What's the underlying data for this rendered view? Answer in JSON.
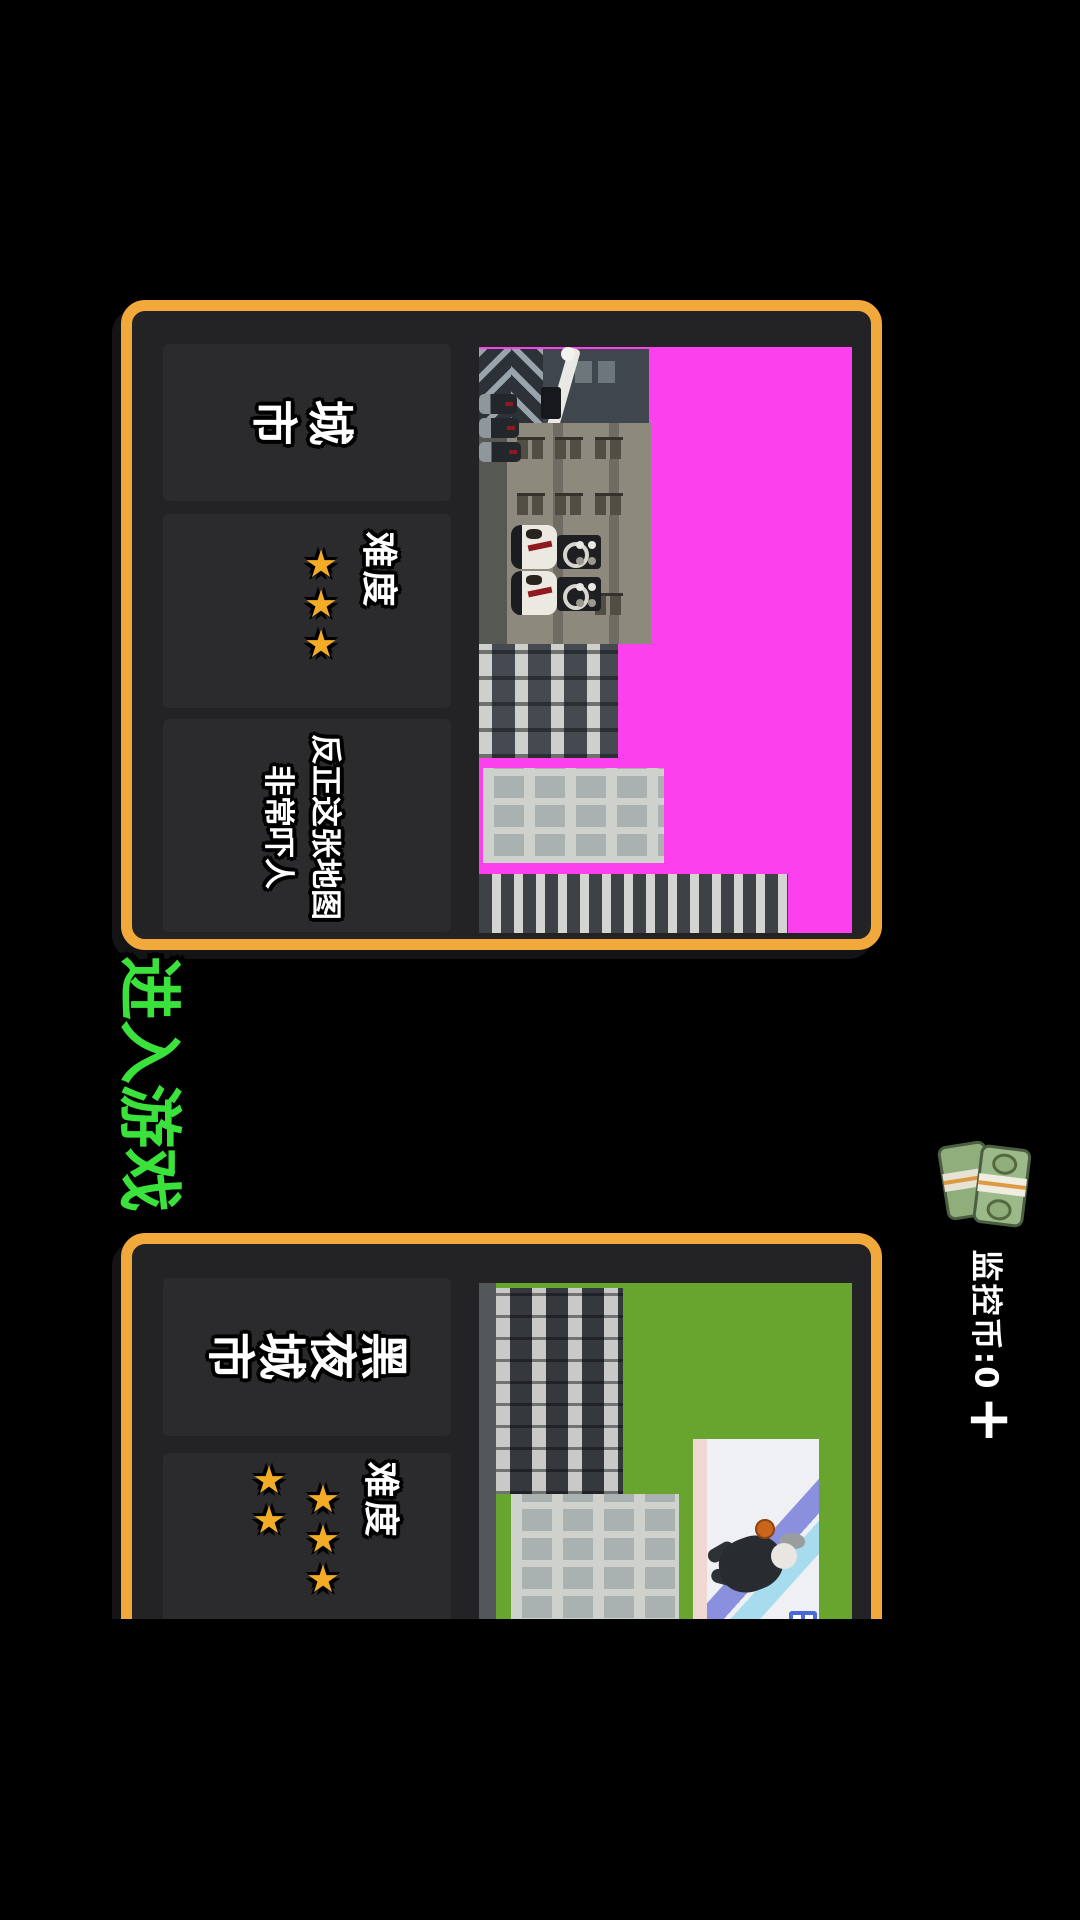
{
  "colors": {
    "accent_orange": "#f2a93c",
    "button_green": "#3be23b",
    "map1_bg_magenta": "#fc40ee",
    "map2_bg_green": "#68a52f",
    "star_gold": "#f3ac25",
    "panel_bg": "#2b2b2d",
    "card_bg": "#232325"
  },
  "enter_button": {
    "label": "进入游戏"
  },
  "currency": {
    "icon": "money-stack",
    "balance_label": "监控币:0",
    "add_button": "+"
  },
  "cards": [
    {
      "title": "城市",
      "difficulty_label": "难度",
      "stars_count": 3,
      "stars": "★★★",
      "description": "反正这张地图非常吓人",
      "map": "magenta-city-preview"
    },
    {
      "title": "黑夜城市",
      "difficulty_label": "难度",
      "stars_count": 5,
      "stars_row_main": "★★★",
      "stars_row_extra": "★★",
      "map": "night-city-preview"
    }
  ]
}
